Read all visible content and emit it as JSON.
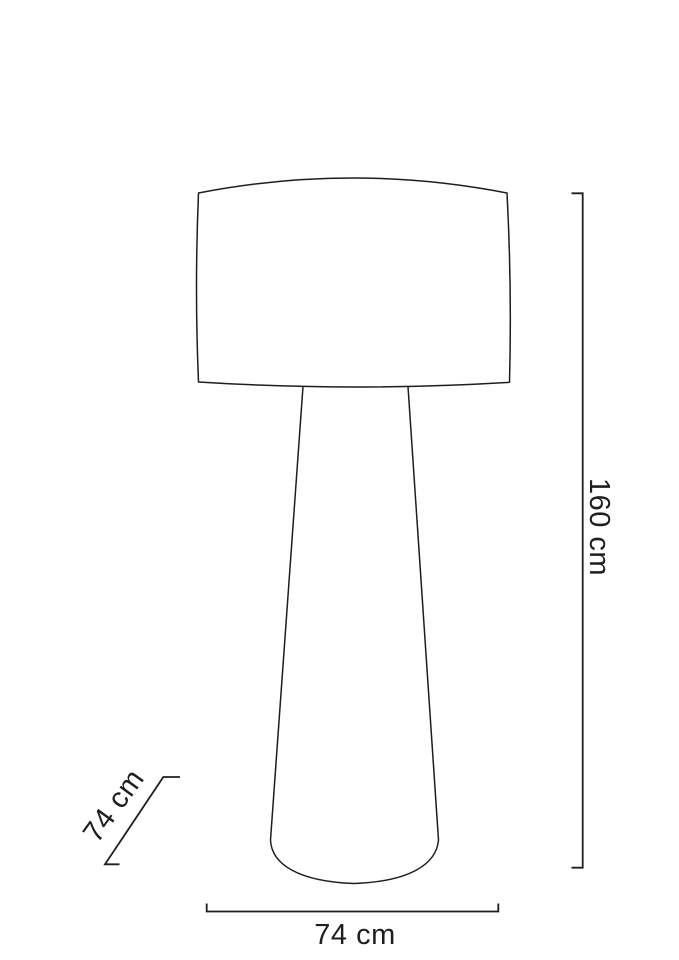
{
  "diagram": {
    "title": "Floor lamp dimension line drawing",
    "background_color": "#ffffff",
    "line_color": "#1e1e1e",
    "text_color": "#1e1e1e",
    "figure": "floor lamp with drum shade and tapered conical base",
    "dimensions": {
      "height": {
        "label": "160 cm",
        "position": "right-vertical"
      },
      "width": {
        "label": "74 cm",
        "position": "bottom-horizontal"
      },
      "depth": {
        "label": "74 cm",
        "position": "lower-left-diagonal"
      }
    }
  }
}
